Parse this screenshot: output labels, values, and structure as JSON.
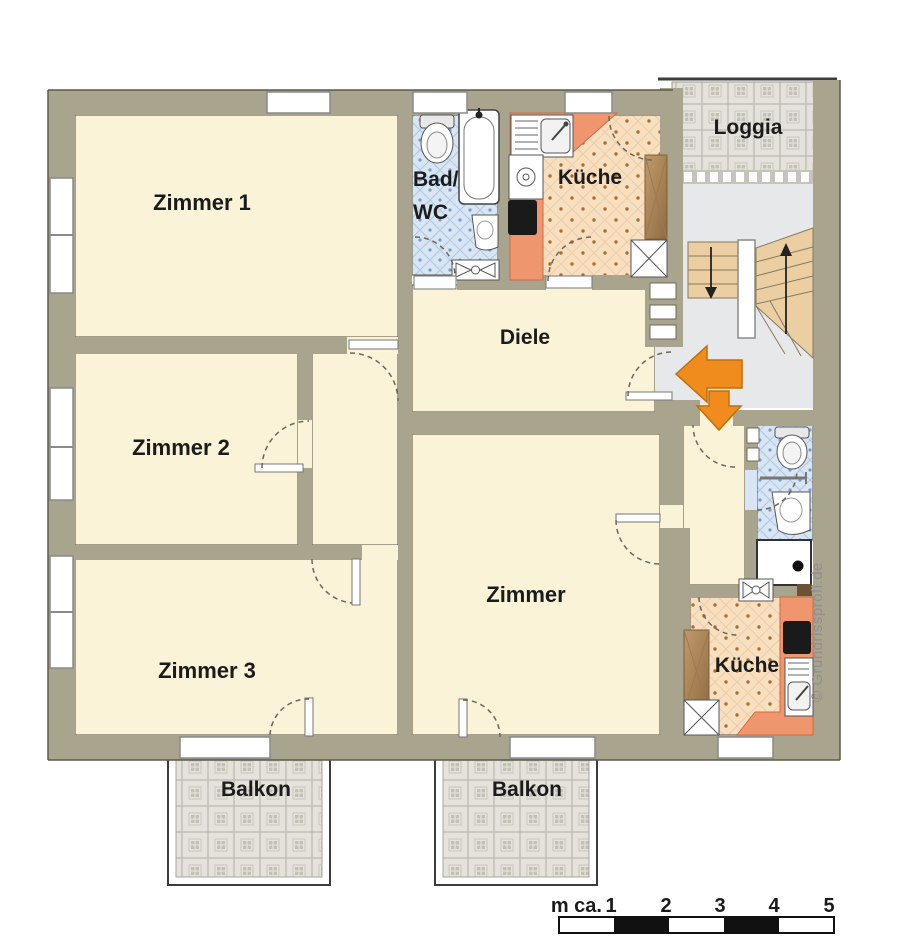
{
  "rooms": {
    "zimmer1": "Zimmer 1",
    "zimmer2": "Zimmer 2",
    "zimmer3": "Zimmer 3",
    "zimmer_center": "Zimmer",
    "diele": "Diele",
    "kueche_top": "Küche",
    "kueche_right": "Küche",
    "bad_line1": "Bad/",
    "bad_line2": "WC",
    "loggia": "Loggia",
    "balkon_left": "Balkon",
    "balkon_right": "Balkon"
  },
  "scale": {
    "prefix": "m ca.",
    "marks": [
      "1",
      "2",
      "3",
      "4",
      "5"
    ]
  },
  "watermark": "© Grundrissprofi.de",
  "colors": {
    "wall": "#a9a48d",
    "room_floor": "#faf3d8",
    "kitchen_floor": "#f8dfc0",
    "kitchen_counter": "#f0966e",
    "bath_floor": "#d8e5f4",
    "stairwell_floor": "#e7e8ea",
    "stair_tread": "#ebcfa3",
    "tile_floor": "#e4e2db",
    "entrance_arrow": "#f08c1e",
    "scale_black": "#111111"
  }
}
